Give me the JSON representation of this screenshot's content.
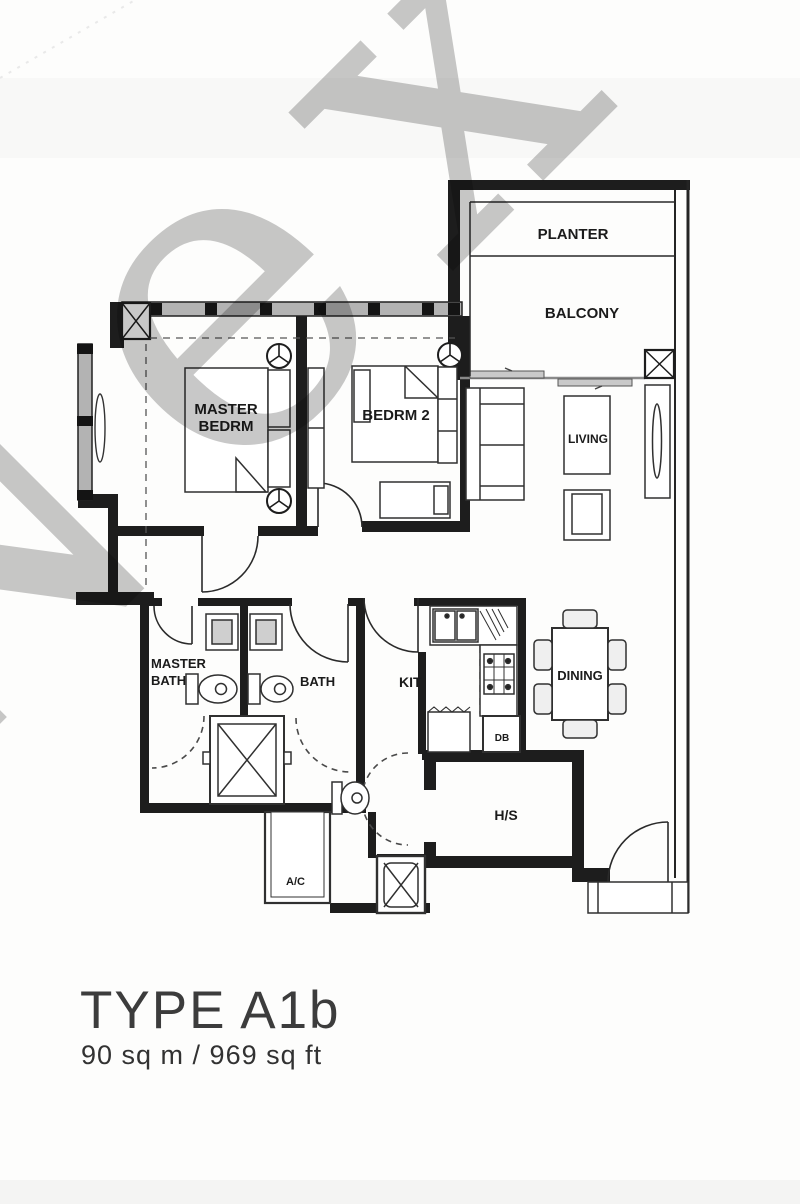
{
  "watermark": {
    "text": "Nex"
  },
  "rooms": {
    "planter": {
      "label": "PLANTER"
    },
    "balcony": {
      "label": "BALCONY"
    },
    "master_bedroom": {
      "label_line1": "MASTER",
      "label_line2": "BEDRM"
    },
    "bedroom_2": {
      "label": "BEDRM 2"
    },
    "living": {
      "label": "LIVING"
    },
    "master_bath": {
      "label_line1": "MASTER",
      "label_line2": "BATH"
    },
    "bath": {
      "label": "BATH"
    },
    "kitchen": {
      "label": "KIT"
    },
    "dining": {
      "label": "DINING"
    },
    "distribution_board": {
      "label": "DB"
    },
    "household_shelter": {
      "label": "H/S"
    },
    "ac_ledge": {
      "label": "A/C"
    }
  },
  "caption": {
    "unit_type": "TYPE A1b",
    "area": "90 sq m / 969 sq ft"
  }
}
